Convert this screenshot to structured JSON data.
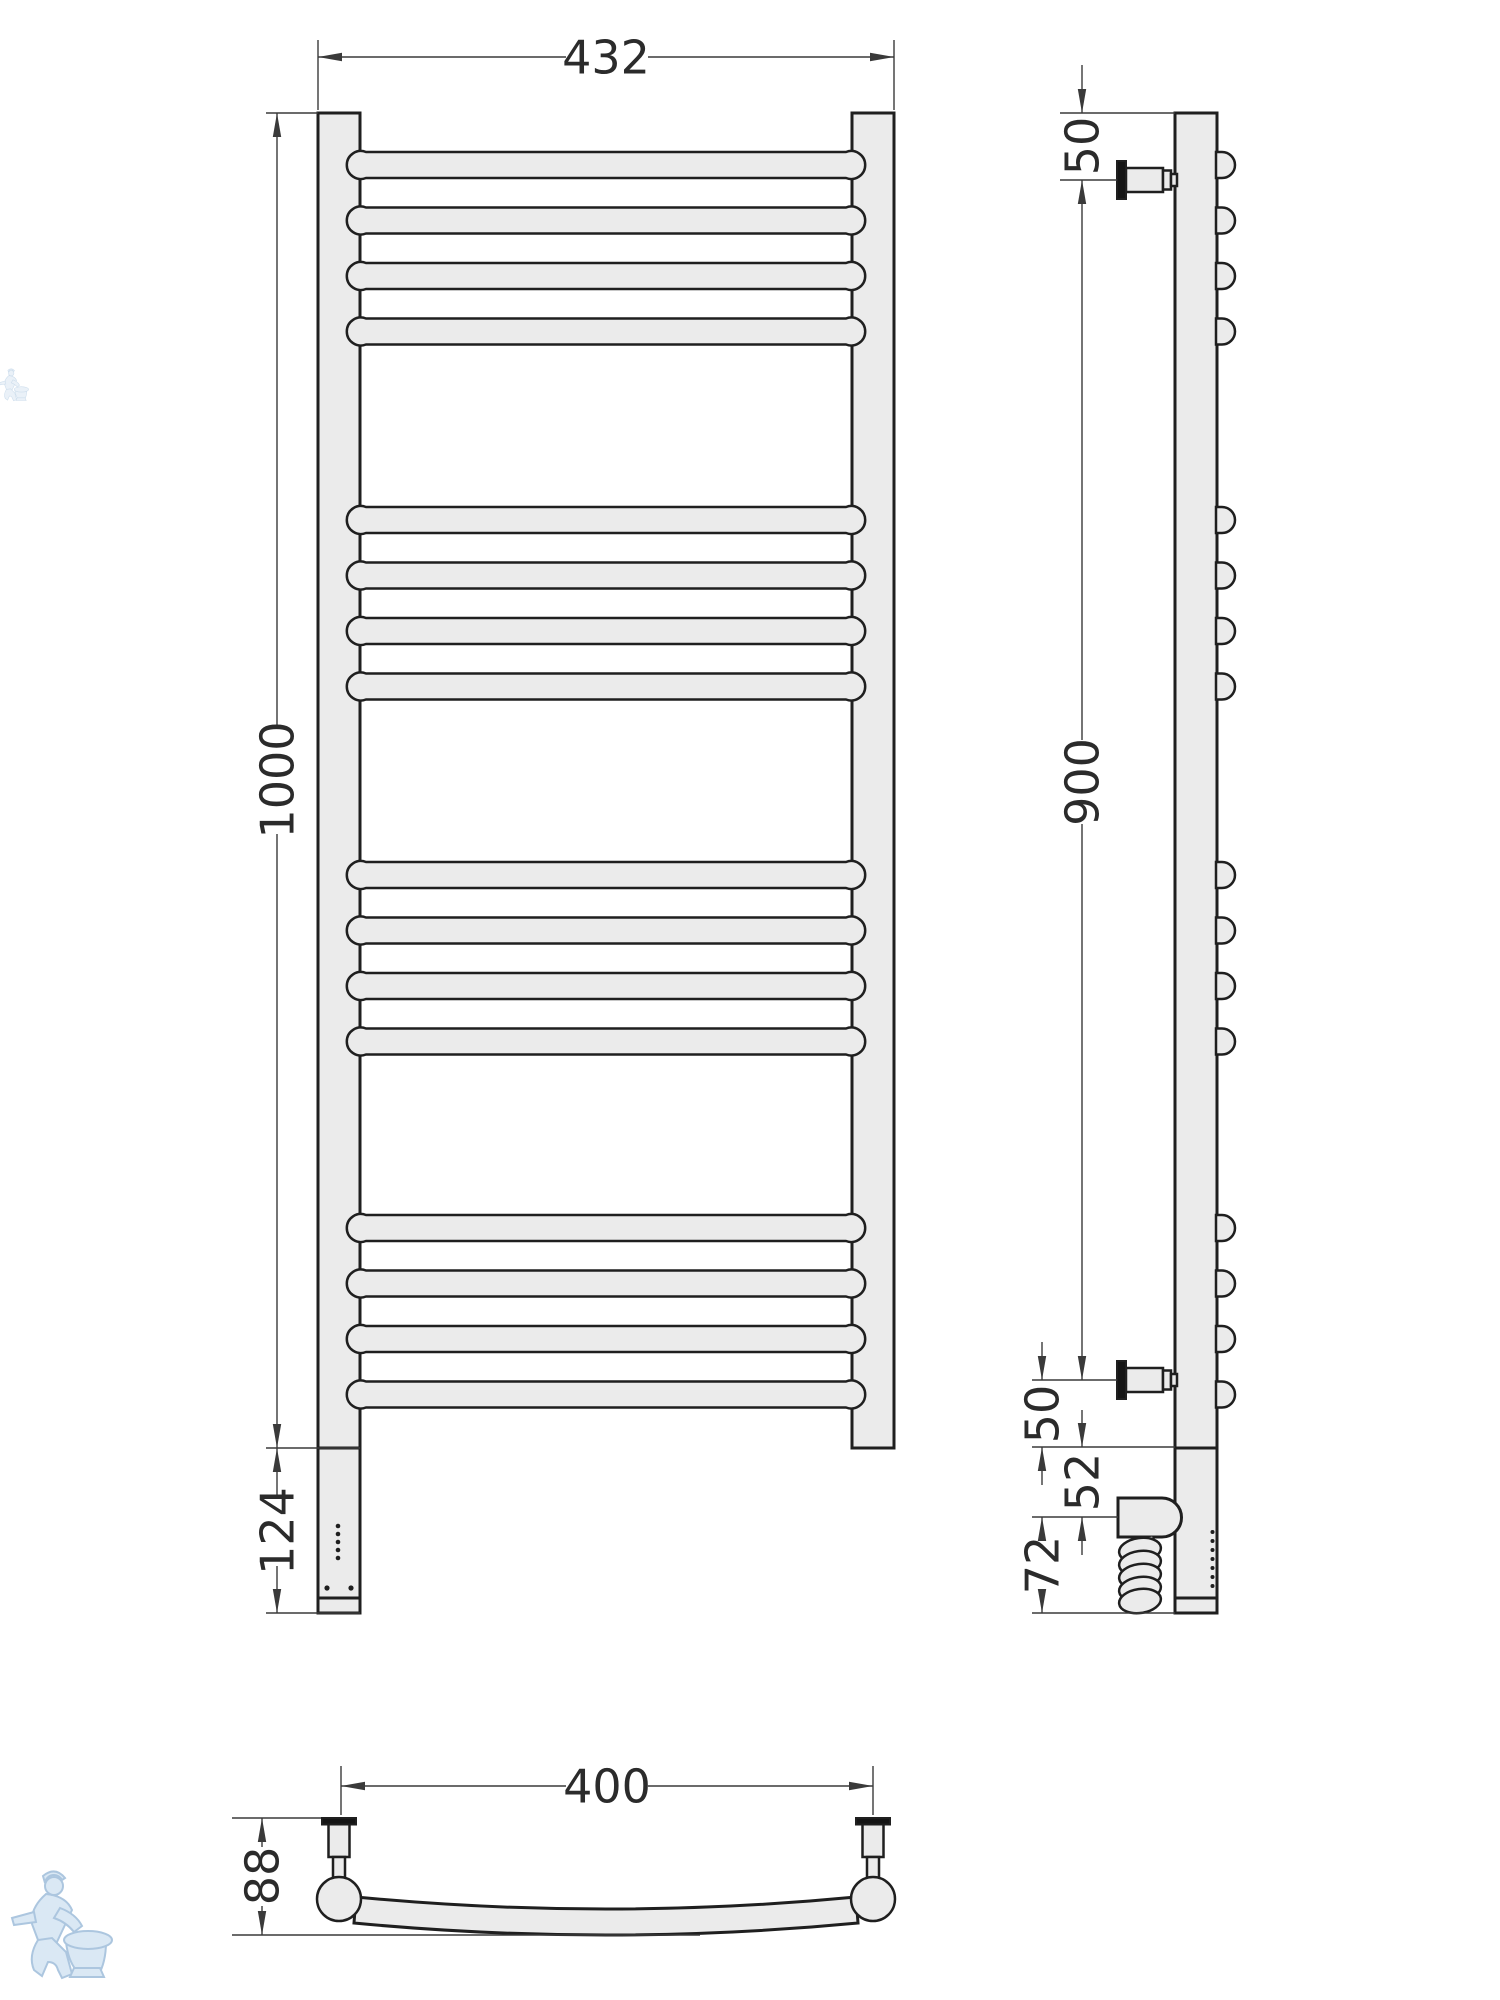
{
  "page": {
    "background": "#ffffff"
  },
  "colors": {
    "line": "#1f1f1f",
    "metal_fill": "#ebebeb",
    "dimension": "#3a3a3a",
    "label_text": "#2b2b2b",
    "flange": "#151515",
    "watermark_stroke": "#a8c4de",
    "watermark_fill": "#d9e7f4"
  },
  "views": {
    "front": {
      "dim_overall_width": "432",
      "dim_overall_height": "1000",
      "dim_bottom_section": "124"
    },
    "side": {
      "dim_top_bracket_offset": "50",
      "dim_bracket_span": "900",
      "dim_bottom_bracket_offset": "50",
      "dim_element_offset": "52",
      "dim_element_to_bottom": "72"
    },
    "top": {
      "dim_mount_centers": "400",
      "dim_depth": "88"
    }
  },
  "watermark": {
    "icon": "plumber-with-toilet-watermark"
  }
}
